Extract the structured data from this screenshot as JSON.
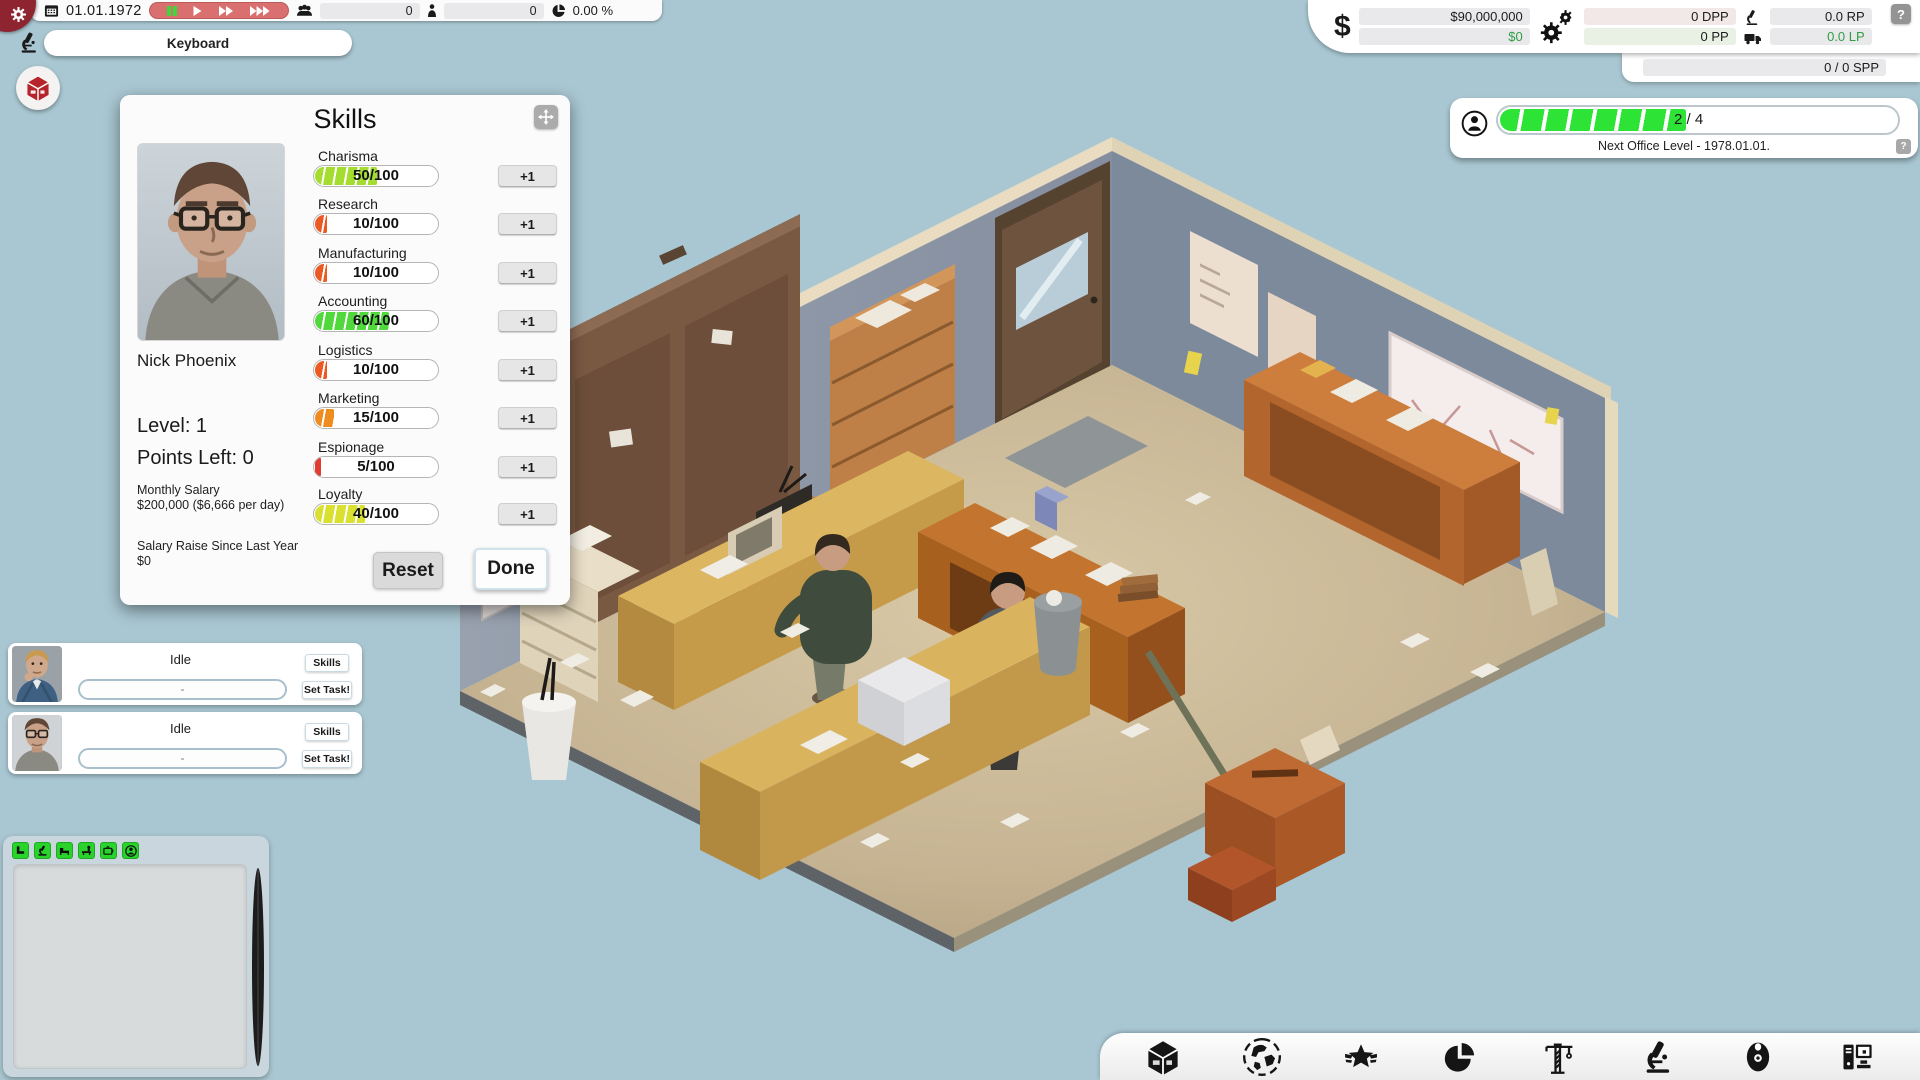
{
  "top_bar": {
    "date": "01.01.1972",
    "controls": [
      {
        "id": "pause",
        "active": true
      },
      {
        "id": "play",
        "active": false
      },
      {
        "id": "fast-forward",
        "active": false
      },
      {
        "id": "fastest",
        "active": false
      }
    ],
    "employees_count": "0",
    "visitors_count": "0",
    "market_share": "0.00 %"
  },
  "research_bar": {
    "current_research": "Keyboard"
  },
  "finance": {
    "dollar_sign": "$",
    "money": "$90,000,000",
    "cash_flow": "$0",
    "dpp": "0 DPP",
    "pp": "0 PP",
    "rp": "0.0 RP",
    "lp": "0.0 LP",
    "spp": "0 / 0 SPP",
    "help": "?"
  },
  "office_level": {
    "progress_label": "2 / 4",
    "progress_percent": 46.5,
    "caption": "Next Office Level - 1978.01.01.",
    "help": "?",
    "fill_color": "#2de436"
  },
  "skills_panel": {
    "title": "Skills",
    "employee_name": "Nick Phoenix",
    "level": "Level: 1",
    "points_left": "Points Left: 0",
    "salary_label": "Monthly Salary",
    "salary_value": "$200,000 ($6,666 per day)",
    "raise_label": "Salary Raise Since Last Year",
    "raise_value": "$0",
    "plus_button": "+1",
    "reset_button": "Reset",
    "done_button": "Done",
    "skills": [
      {
        "name": "Charisma",
        "value": 50,
        "max": 100,
        "display": "50/100",
        "color": "#a4dc30"
      },
      {
        "name": "Research",
        "value": 10,
        "max": 100,
        "display": "10/100",
        "color": "#ec5a24"
      },
      {
        "name": "Manufacturing",
        "value": 10,
        "max": 100,
        "display": "10/100",
        "color": "#ec5a24"
      },
      {
        "name": "Accounting",
        "value": 60,
        "max": 100,
        "display": "60/100",
        "color": "#50d83c"
      },
      {
        "name": "Logistics",
        "value": 10,
        "max": 100,
        "display": "10/100",
        "color": "#ec5a24"
      },
      {
        "name": "Marketing",
        "value": 15,
        "max": 100,
        "display": "15/100",
        "color": "#ef8c1f"
      },
      {
        "name": "Espionage",
        "value": 5,
        "max": 100,
        "display": "5/100",
        "color": "#e03c31"
      },
      {
        "name": "Loyalty",
        "value": 40,
        "max": 100,
        "display": "40/100",
        "color": "#d9e030"
      }
    ]
  },
  "employee_list": [
    {
      "status": "Idle",
      "task": "-",
      "skills_button": "Skills",
      "set_task_button": "Set Task!",
      "portrait": "blond-man-blue-suit"
    },
    {
      "status": "Idle",
      "task": "-",
      "skills_button": "Skills",
      "set_task_button": "Set Task!",
      "portrait": "man-glasses-gray-shirt"
    }
  ],
  "build_panel": {
    "buttons": [
      {
        "icon": "chair-icon"
      },
      {
        "icon": "microscope-icon"
      },
      {
        "icon": "sofa-icon"
      },
      {
        "icon": "desk-person-icon"
      },
      {
        "icon": "tv-icon"
      },
      {
        "icon": "character-icon"
      }
    ]
  },
  "toolbar": {
    "items": [
      {
        "name": "company",
        "icon": "company-cube-icon"
      },
      {
        "name": "world",
        "icon": "world-icon"
      },
      {
        "name": "achievements",
        "icon": "achievements-star-icon"
      },
      {
        "name": "statistics",
        "icon": "stats-pie-icon"
      },
      {
        "name": "construction",
        "icon": "construction-crane-icon"
      },
      {
        "name": "research",
        "icon": "research-microscope-icon"
      },
      {
        "name": "products",
        "icon": "products-disc-icon"
      },
      {
        "name": "hardware",
        "icon": "hardware-computer-icon"
      }
    ]
  }
}
